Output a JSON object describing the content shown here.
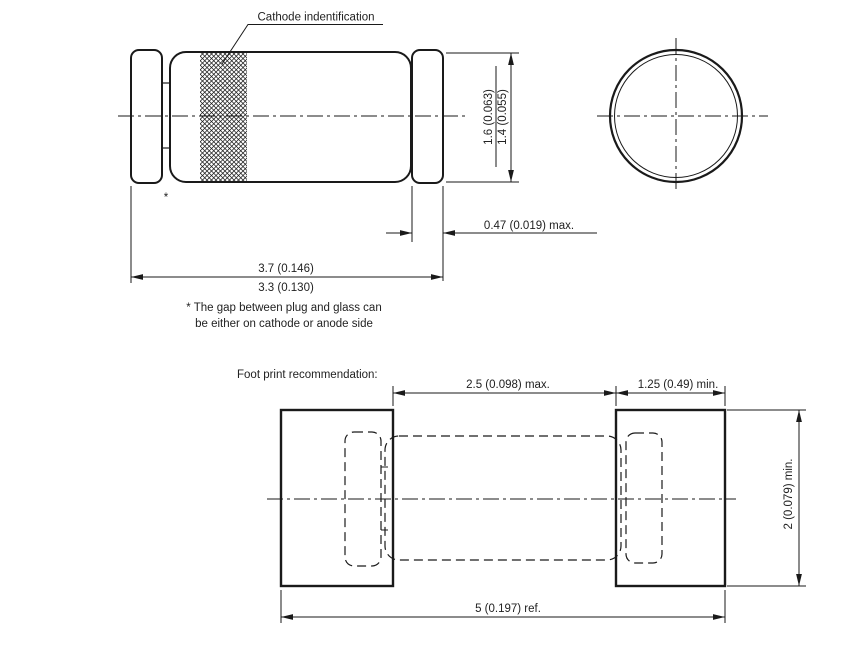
{
  "drawing": {
    "side_view": {
      "cathode_label": "Cathode indentification",
      "gap_marker": "*",
      "dimensions": {
        "diameter_max": "1.6 (0.063)",
        "diameter_min": "1.4 (0.055)",
        "cap_length": "0.47 (0.019) max.",
        "body_length_max": "3.7 (0.146)",
        "body_length_min": "3.3 (0.130)"
      }
    },
    "note": {
      "line1": "* The gap between plug and glass can",
      "line2": "be either on cathode or anode side"
    },
    "footprint": {
      "title": "Foot print recommendation:",
      "dimensions": {
        "pad_gap": "2.5 (0.098) max.",
        "pad_width": "1.25 (0.49) min.",
        "pad_height": "2 (0.079) min.",
        "total_length": "5 (0.197) ref."
      }
    },
    "colors": {
      "line": "#1a1a1a",
      "text": "#222222",
      "background": "#ffffff"
    }
  }
}
